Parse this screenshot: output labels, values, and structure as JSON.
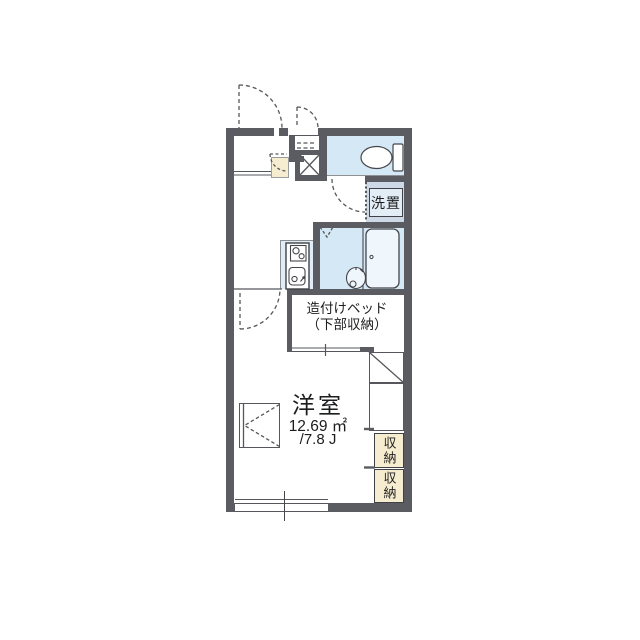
{
  "floorplan": {
    "type": "japanese-apartment-1K-floorplan",
    "rooms": {
      "main_room": {
        "name": "洋室",
        "area_m2": "12.69 ㎡",
        "area_jo": "/7.8 J"
      },
      "built_in_bed": {
        "line1": "造付けベッド",
        "line2": "（下部収納）"
      },
      "laundry_space": {
        "label": "洗置"
      },
      "storage_upper": {
        "label": "収納"
      },
      "storage_lower": {
        "label": "収納"
      }
    },
    "icons": [
      "toilet-icon",
      "bathtub-icon",
      "washbasin-icon",
      "stove-icon",
      "kitchen-sink-icon",
      "door-swing-arc",
      "window-symbol",
      "shoe-closet-x",
      "shelf-dashes"
    ],
    "colors": {
      "wall": "#5a5c61",
      "water_area": "#d5e8f5",
      "laundry_area": "#cdd9e6",
      "kitchen_floor": "#dfedf8",
      "storage_beige": "#f6ecd0",
      "line": "#44464b",
      "background": "#ffffff"
    }
  }
}
